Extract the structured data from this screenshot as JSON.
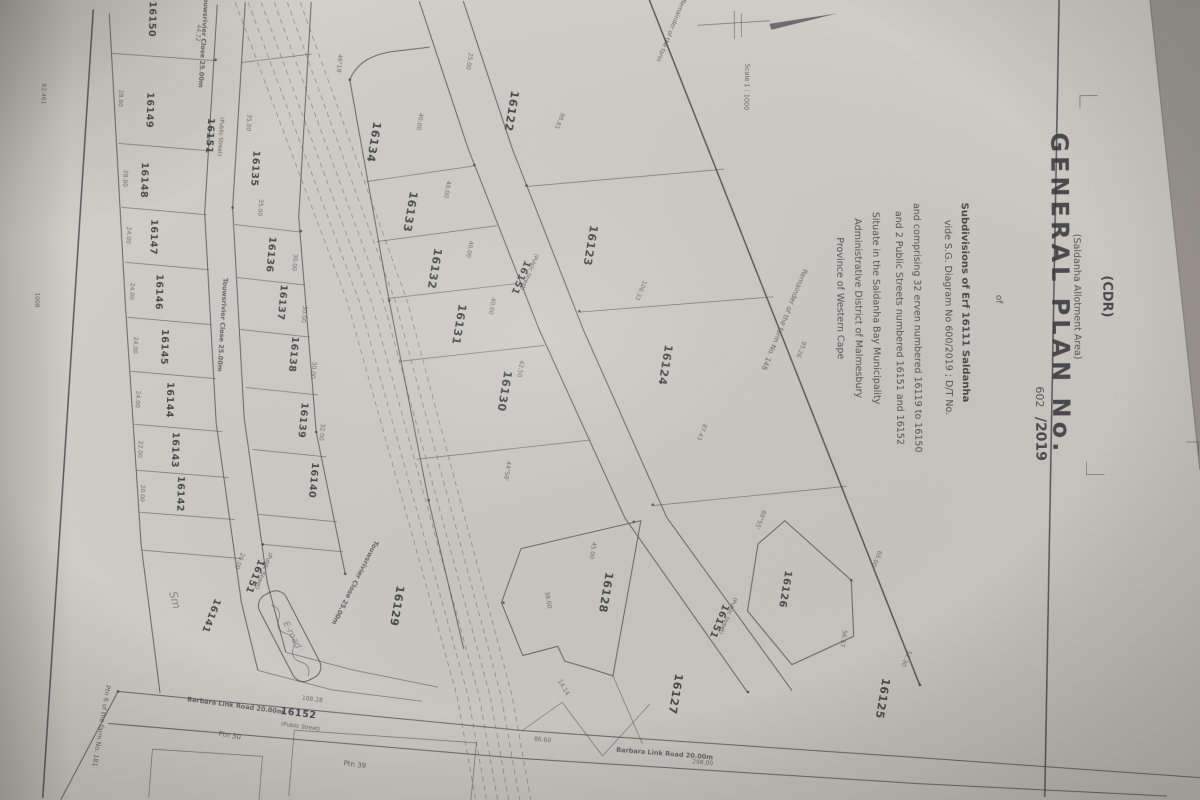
{
  "titleblock": {
    "cdr": "(CDR)",
    "area_note": "(Saldanha Allotment Area)",
    "title": "GENERAL PLAN No.",
    "plan_no_written": "602",
    "plan_no_year": "/2019",
    "of_word": "of",
    "line_subdivisions": "Subdivisions of Erf 16111 Saldanha",
    "line_vide": "vide S.G. Diagram No 600/2019 ; D/T No.",
    "line_comprising": "and comprising 32 erven numbered 16119 to 16150",
    "line_streets": "and 2 Public Streets numbered 16151 and 16152",
    "line_situate": "Situate in the Saldanha Bay Municipality",
    "line_district": "Administrative District of Malmesbury",
    "line_province": "Province of Western Cape"
  },
  "colors": {
    "paper": "#cdcac4",
    "ink": "#3a3b41",
    "background_beyond_paper": "#9a968f"
  },
  "erven": [
    {
      "no": "16150",
      "x": 152,
      "y": 16,
      "r": 92
    },
    {
      "no": "16149",
      "x": 149,
      "y": 107,
      "r": 92
    },
    {
      "no": "16148",
      "x": 143,
      "y": 177,
      "r": 92
    },
    {
      "no": "16147",
      "x": 152,
      "y": 234,
      "r": 92
    },
    {
      "no": "16146",
      "x": 157,
      "y": 289,
      "r": 92
    },
    {
      "no": "16145",
      "x": 162,
      "y": 344,
      "r": 92
    },
    {
      "no": "16144",
      "x": 167,
      "y": 397,
      "r": 92
    },
    {
      "no": "16143",
      "x": 172,
      "y": 447,
      "r": 92
    },
    {
      "no": "16142",
      "x": 177,
      "y": 491,
      "r": 92
    },
    {
      "no": "16141",
      "x": 207,
      "y": 612,
      "r": 112
    },
    {
      "no": "16135",
      "x": 254,
      "y": 166,
      "r": 94
    },
    {
      "no": "16136",
      "x": 269,
      "y": 252,
      "r": 96
    },
    {
      "no": "16137",
      "x": 280,
      "y": 300,
      "r": 96
    },
    {
      "no": "16138",
      "x": 291,
      "y": 352,
      "r": 96
    },
    {
      "no": "16139",
      "x": 300,
      "y": 418,
      "r": 96
    },
    {
      "no": "16140",
      "x": 310,
      "y": 478,
      "r": 96
    },
    {
      "no": "16134",
      "x": 372,
      "y": 140,
      "r": 100,
      "s": 11
    },
    {
      "no": "16133",
      "x": 408,
      "y": 210,
      "r": 100,
      "s": 11
    },
    {
      "no": "16132",
      "x": 432,
      "y": 267,
      "r": 100,
      "s": 11
    },
    {
      "no": "16131",
      "x": 456,
      "y": 323,
      "r": 100,
      "s": 11
    },
    {
      "no": "16130",
      "x": 501,
      "y": 390,
      "r": 100,
      "s": 11
    },
    {
      "no": "16129",
      "x": 392,
      "y": 604,
      "r": 100,
      "s": 11
    },
    {
      "no": "16122",
      "x": 510,
      "y": 110,
      "r": 100,
      "s": 11
    },
    {
      "no": "16123",
      "x": 588,
      "y": 245,
      "r": 100,
      "s": 11
    },
    {
      "no": "16124",
      "x": 662,
      "y": 365,
      "r": 100,
      "s": 11
    },
    {
      "no": "16128",
      "x": 601,
      "y": 592,
      "r": 100,
      "s": 11
    },
    {
      "no": "16127",
      "x": 670,
      "y": 694,
      "r": 100,
      "s": 11
    },
    {
      "no": "16126",
      "x": 781,
      "y": 590,
      "r": 100,
      "s": 10
    },
    {
      "no": "16125",
      "x": 877,
      "y": 700,
      "r": 100,
      "s": 11
    }
  ],
  "street_labels": [
    {
      "no": "16151",
      "sub": "(Public Street)",
      "x": 209,
      "y": 133,
      "r": 94,
      "sx": 221,
      "sy": 134
    },
    {
      "no": "16151",
      "sub": "(Public Street)",
      "x": 251,
      "y": 573,
      "r": 112,
      "sx": 261,
      "sy": 568
    },
    {
      "no": "16151",
      "sub": "(Public Street)",
      "x": 519,
      "y": 276,
      "r": 113,
      "sx": 529,
      "sy": 271
    },
    {
      "no": "16151",
      "sub": "(Public Street)",
      "x": 715,
      "y": 621,
      "r": 113,
      "sx": 725,
      "sy": 616
    },
    {
      "no": "16152",
      "sub": "(Public Street)",
      "x": 296,
      "y": 714,
      "r": 8,
      "sx": 298,
      "sy": 726
    }
  ],
  "road_names": [
    {
      "t": "Barbara Link Road 20.00m",
      "x": 233,
      "y": 705,
      "r": 8
    },
    {
      "t": "Barbara Link Road 20.00m",
      "x": 662,
      "y": 756,
      "r": 5
    },
    {
      "t": "Touwsrivier Close 25.00m",
      "x": 204,
      "y": 38,
      "r": 94
    },
    {
      "t": "Touwsrivier Close 25.00m",
      "x": 221,
      "y": 322,
      "r": 94
    },
    {
      "t": "Touwsrivier Close 25.00m",
      "x": 352,
      "y": 580,
      "r": 118
    }
  ],
  "annotations": [
    {
      "t": "Remainder of the farm No. 148",
      "x": 783,
      "y": 320,
      "r": 113,
      "s": 7
    },
    {
      "t": "Remainder of the farm",
      "x": 672,
      "y": 30,
      "r": 113,
      "s": 6
    },
    {
      "t": "Ptn 30",
      "x": 227,
      "y": 735,
      "r": 10,
      "s": 7
    },
    {
      "t": "Ptn 39",
      "x": 352,
      "y": 765,
      "r": 8,
      "s": 7
    },
    {
      "t": "Ptn 6 of the farm No. 181",
      "x": 97,
      "y": 722,
      "r": 100,
      "s": 6.5
    },
    {
      "t": "82.461",
      "x": 44,
      "y": 90,
      "r": 92,
      "s": 6
    },
    {
      "t": "1008",
      "x": 36,
      "y": 296,
      "r": 92,
      "s": 6
    },
    {
      "t": "Scale 1 : 1000",
      "x": 747,
      "y": 88,
      "r": 92,
      "s": 6.5
    },
    {
      "t": "Sm",
      "x": 170,
      "y": 598,
      "r": 75,
      "s": 11,
      "hand": true
    },
    {
      "t": "E-road",
      "x": 288,
      "y": 634,
      "r": 63,
      "s": 9,
      "hand": true
    }
  ],
  "dimensions": [
    {
      "t": "28.00",
      "x": 121,
      "y": 95,
      "r": 93
    },
    {
      "t": "28.00",
      "x": 125,
      "y": 175,
      "r": 93
    },
    {
      "t": "24.00",
      "x": 128,
      "y": 232,
      "r": 93
    },
    {
      "t": "24.00",
      "x": 131,
      "y": 288,
      "r": 93
    },
    {
      "t": "24.00",
      "x": 134,
      "y": 342,
      "r": 93
    },
    {
      "t": "24.00",
      "x": 136,
      "y": 396,
      "r": 93
    },
    {
      "t": "22.00",
      "x": 138,
      "y": 446,
      "r": 93
    },
    {
      "t": "20.00",
      "x": 140,
      "y": 490,
      "r": 93
    },
    {
      "t": "44.72",
      "x": 199,
      "y": 30,
      "r": 95
    },
    {
      "t": "35.00",
      "x": 249,
      "y": 120,
      "r": 95
    },
    {
      "t": "35.00",
      "x": 260,
      "y": 205,
      "r": 95
    },
    {
      "t": "30.00",
      "x": 294,
      "y": 260,
      "r": 96
    },
    {
      "t": "30.00",
      "x": 303,
      "y": 312,
      "r": 96
    },
    {
      "t": "30.00",
      "x": 312,
      "y": 368,
      "r": 96
    },
    {
      "t": "32.00",
      "x": 320,
      "y": 430,
      "r": 96
    },
    {
      "t": "40.00",
      "x": 420,
      "y": 120,
      "r": 100
    },
    {
      "t": "40.00",
      "x": 447,
      "y": 188,
      "r": 100
    },
    {
      "t": "40.00",
      "x": 469,
      "y": 248,
      "r": 100
    },
    {
      "t": "40.00",
      "x": 491,
      "y": 305,
      "r": 100
    },
    {
      "t": "42.50",
      "x": 519,
      "y": 368,
      "r": 100
    },
    {
      "t": "98.81",
      "x": 560,
      "y": 120,
      "r": 113
    },
    {
      "t": "106.33",
      "x": 640,
      "y": 290,
      "r": 113
    },
    {
      "t": "87.43",
      "x": 700,
      "y": 432,
      "r": 113
    },
    {
      "t": "108.28",
      "x": 310,
      "y": 699,
      "r": 8
    },
    {
      "t": "86.60",
      "x": 540,
      "y": 741,
      "r": 6
    },
    {
      "t": "298.00",
      "x": 700,
      "y": 765,
      "r": 5
    },
    {
      "t": "56.57",
      "x": 840,
      "y": 640,
      "r": 100
    },
    {
      "t": "25.00",
      "x": 470,
      "y": 60,
      "r": 100
    },
    {
      "t": "20.00",
      "x": 237,
      "y": 558,
      "r": 110
    },
    {
      "t": "14.14",
      "x": 560,
      "y": 688,
      "r": 60
    },
    {
      "t": "95.26",
      "x": 800,
      "y": 350,
      "r": 113
    },
    {
      "t": "45.00",
      "x": 590,
      "y": 550,
      "r": 100
    },
    {
      "t": "38.00",
      "x": 545,
      "y": 600,
      "r": 80
    },
    {
      "t": "65.00",
      "x": 874,
      "y": 560,
      "r": 113
    },
    {
      "t": "52.30",
      "x": 903,
      "y": 660,
      "r": 113
    },
    {
      "t": "46°18'",
      "x": 340,
      "y": 62,
      "r": 96
    },
    {
      "t": "44°58'",
      "x": 505,
      "y": 470,
      "r": 100
    },
    {
      "t": "89°55'",
      "x": 758,
      "y": 520,
      "r": 113
    }
  ],
  "beacons": [
    [
      218,
      57
    ],
    [
      210,
      147
    ],
    [
      234,
      205
    ],
    [
      302,
      229
    ],
    [
      316,
      430
    ],
    [
      352,
      78
    ],
    [
      390,
      299
    ],
    [
      428,
      499
    ],
    [
      476,
      164
    ],
    [
      528,
      185
    ],
    [
      580,
      311
    ],
    [
      652,
      505
    ],
    [
      746,
      693
    ],
    [
      918,
      687
    ],
    [
      633,
      522
    ],
    [
      502,
      602
    ],
    [
      850,
      582
    ],
    [
      116,
      688
    ],
    [
      262,
      542
    ],
    [
      344,
      572
    ]
  ]
}
